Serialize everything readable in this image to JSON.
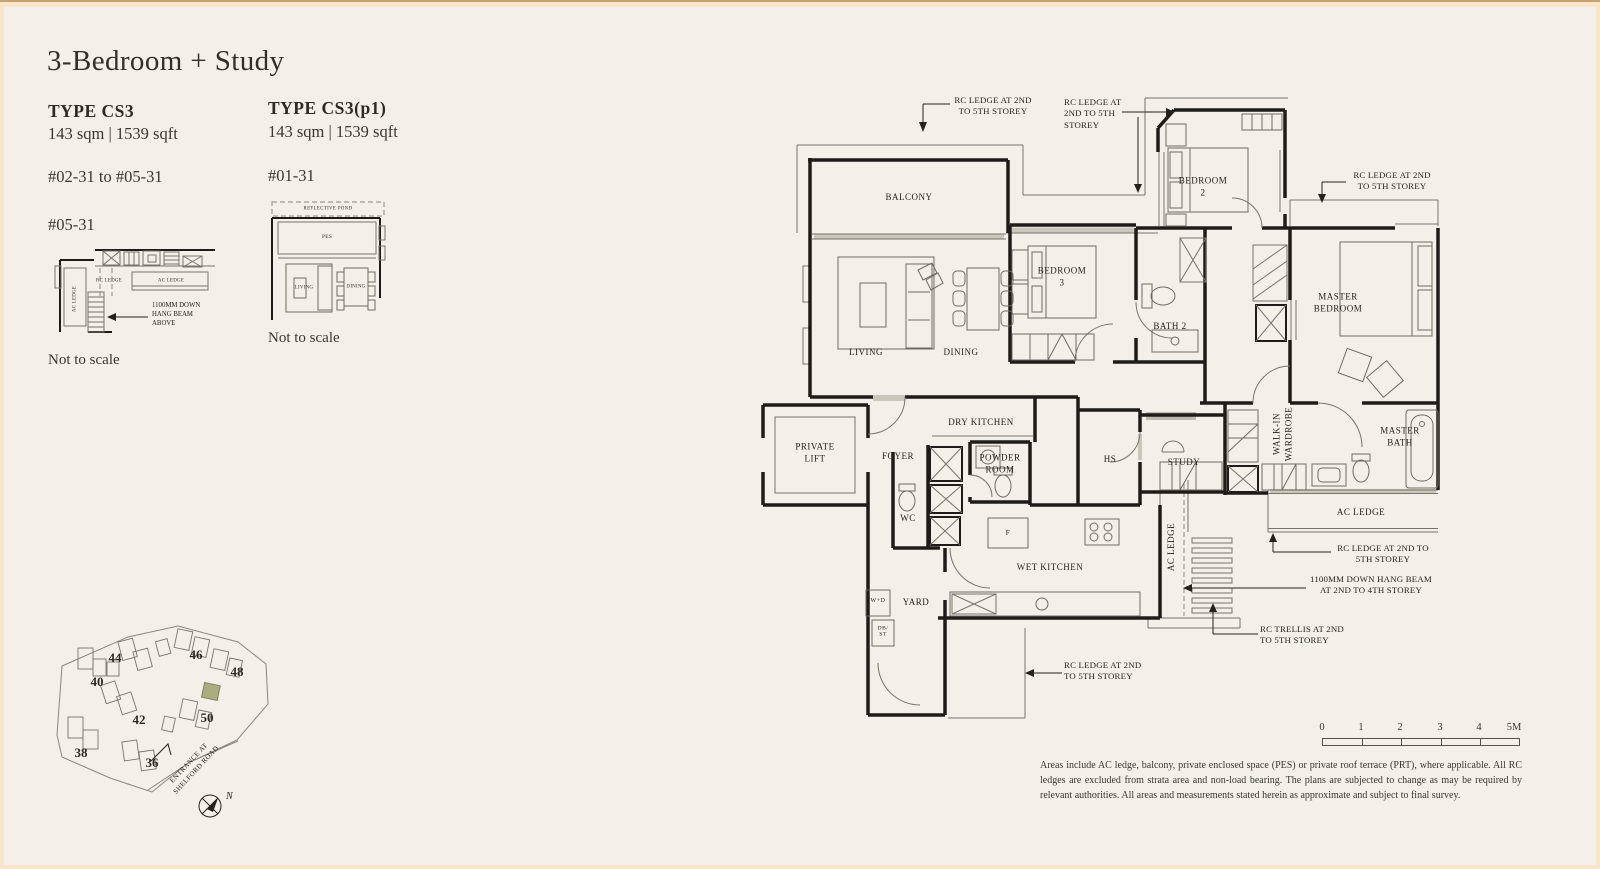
{
  "header": {
    "title": "3-Bedroom + Study"
  },
  "types": {
    "cs3": {
      "name": "TYPE CS3",
      "area": "143 sqm | 1539 sqft",
      "units": "#02-31 to #05-31",
      "detail_unit": "#05-31",
      "scale_note": "Not to scale"
    },
    "cs3p1": {
      "name": "TYPE CS3(p1)",
      "area": "143 sqm | 1539 sqft",
      "units": "#01-31",
      "scale_note": "Not to scale"
    }
  },
  "mini_cs3": {
    "rc_ledge": "RC LEDGE",
    "ac_ledge": "AC LEDGE",
    "ac_ledge_side": "AC LEDGE",
    "beam_note": "1100MM DOWN\nHANG BEAM\nABOVE"
  },
  "mini_cs3p1": {
    "reflective_pond": "REFLECTIVE POND",
    "pes": "PES",
    "living": "LIVING",
    "dining": "DINING"
  },
  "plan": {
    "rooms": {
      "balcony": "BALCONY",
      "living": "LIVING",
      "dining": "DINING",
      "bedroom3": "BEDROOM\n3",
      "bedroom2": "BEDROOM\n2",
      "master_bedroom": "MASTER\nBEDROOM",
      "bath2": "BATH 2",
      "private_lift": "PRIVATE\nLIFT",
      "foyer": "FOYER",
      "dry_kitchen": "DRY KITCHEN",
      "powder_room": "POWDER\nROOM",
      "wc": "WC",
      "hs": "HS",
      "study": "STUDY",
      "walk_in_wardrobe": "WALK-IN\nWARDROBE",
      "master_bath": "MASTER\nBATH",
      "ac_ledge_right": "AC LEDGE",
      "ac_ledge_mid": "AC LEDGE",
      "wet_kitchen": "WET KITCHEN",
      "yard": "YARD",
      "washer_dryer": "W+D",
      "db_st": "DB/\nST",
      "fridge": "F"
    },
    "annotations": {
      "rc_ledge_top_left": "RC LEDGE AT 2ND\nTO 5TH STOREY",
      "rc_ledge_top_mid": "RC LEDGE AT\n2ND TO 5TH\nSTOREY",
      "rc_ledge_top_right": "RC LEDGE AT 2ND\nTO 5TH STOREY",
      "rc_ledge_right": "RC LEDGE AT 2ND TO\n5TH STOREY",
      "hang_beam": "1100MM DOWN HANG BEAM\nAT 2ND TO 4TH STOREY",
      "rc_trellis": "RC TRELLIS AT 2ND\nTO 5TH STOREY",
      "rc_ledge_bottom": "RC LEDGE AT 2ND\nTO 5TH STOREY"
    }
  },
  "site_map": {
    "blocks": {
      "b36": "36",
      "b38": "38",
      "b40": "40",
      "b42": "42",
      "b44": "44",
      "b46": "46",
      "b48": "48",
      "b50": "50"
    },
    "entrance": "ENTRANCE AT\nSHELFORD ROAD",
    "north": "N",
    "highlight_color": "#a9ae80"
  },
  "scale_bar": {
    "ticks": [
      "0",
      "1",
      "2",
      "3",
      "4",
      "5M"
    ]
  },
  "disclaimer": {
    "text": "Areas include AC ledge, balcony, private enclosed space (PES) or private roof terrace (PRT), where applicable. All RC ledges are excluded from strata area and non-load bearing. The plans are subjected to change as may be required by relevant authorities. All areas and measurements stated herein as approximate and subject to final survey."
  }
}
